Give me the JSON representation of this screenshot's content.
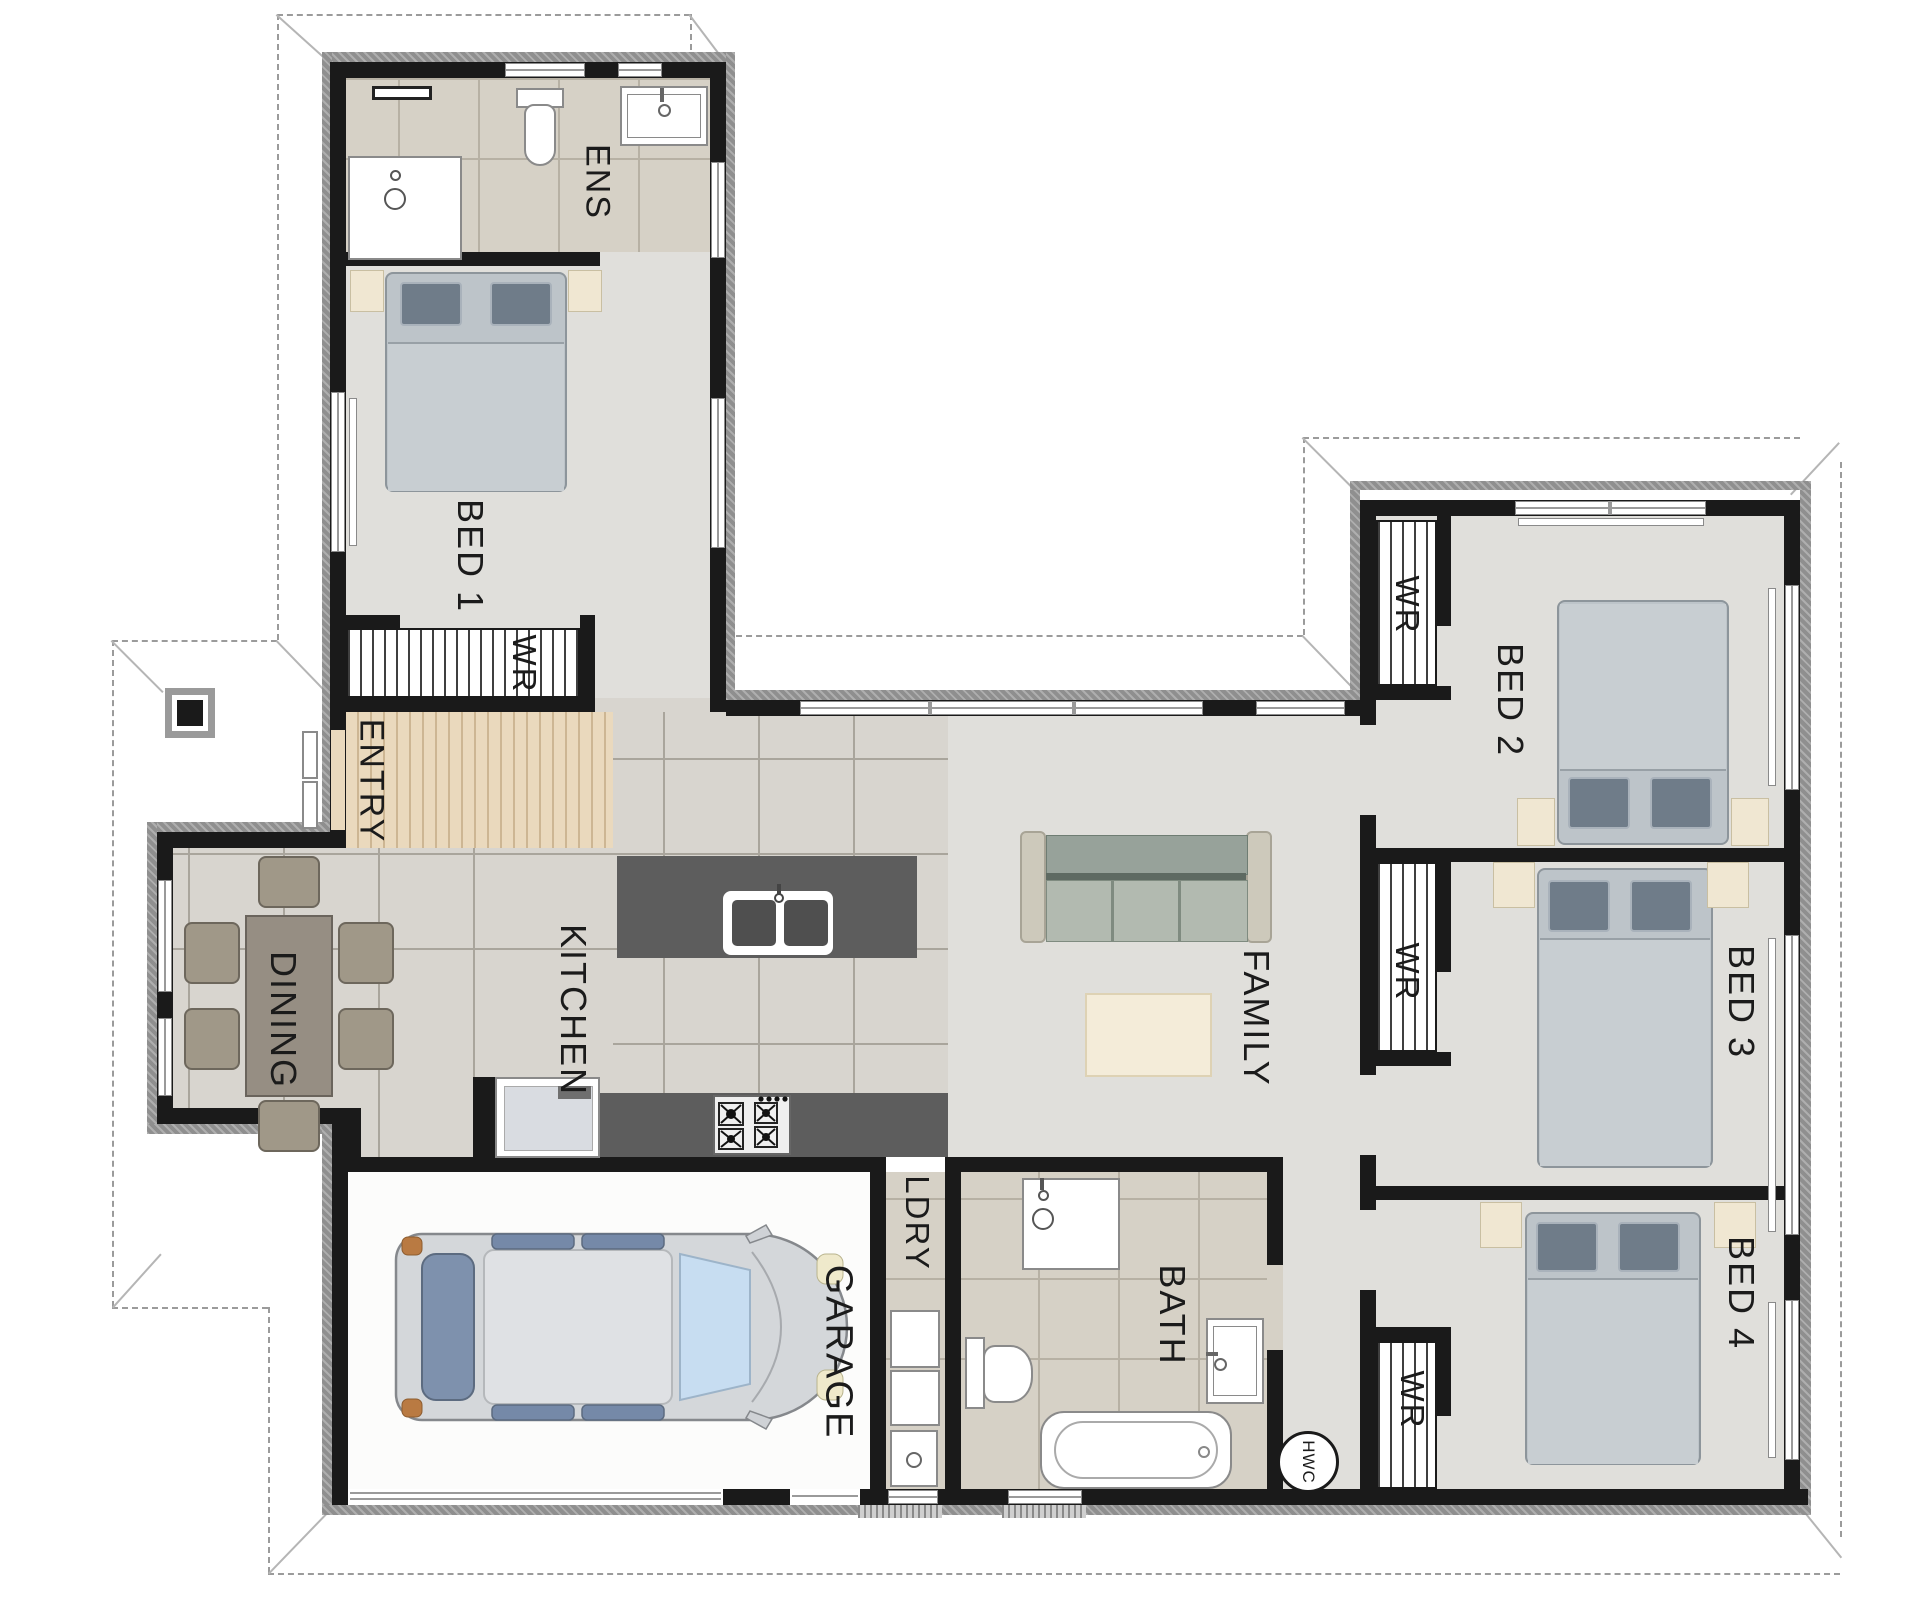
{
  "plan_type": "residential-floor-plan",
  "colors": {
    "wall": "#1a1a1a",
    "exterior_trim": "#8f8f8f",
    "carpet": "#e0dfdb",
    "tile": "#d8d5cf",
    "wet_tile": "#d6d1c6",
    "entry_wood": "#ead9bd",
    "bench_dark": "#5d5d5d",
    "cream_accent": "#f0e7d2",
    "roof_dash": "#9b9b9b",
    "bed_fill": "#bdc4c9",
    "sofa_fill": "#b2bab0"
  },
  "rooms": [
    {
      "id": "ens",
      "label": "ENS",
      "type": "ensuite"
    },
    {
      "id": "bed1",
      "label": "BED 1",
      "type": "bedroom"
    },
    {
      "id": "wr-bed1",
      "label": "WR",
      "type": "wardrobe"
    },
    {
      "id": "entry",
      "label": "ENTRY",
      "type": "entry"
    },
    {
      "id": "dining",
      "label": "DINING",
      "type": "dining"
    },
    {
      "id": "kitchen",
      "label": "KITCHEN",
      "type": "kitchen"
    },
    {
      "id": "family",
      "label": "FAMILY",
      "type": "living"
    },
    {
      "id": "bed2",
      "label": "BED 2",
      "type": "bedroom"
    },
    {
      "id": "wr-bed2",
      "label": "WR",
      "type": "wardrobe"
    },
    {
      "id": "bed3",
      "label": "BED 3",
      "type": "bedroom"
    },
    {
      "id": "wr-bed3",
      "label": "WR",
      "type": "wardrobe"
    },
    {
      "id": "bed4",
      "label": "BED 4",
      "type": "bedroom"
    },
    {
      "id": "wr-bed4",
      "label": "WR",
      "type": "wardrobe"
    },
    {
      "id": "ldry",
      "label": "LDRY",
      "type": "laundry"
    },
    {
      "id": "bath",
      "label": "BATH",
      "type": "bathroom"
    },
    {
      "id": "hwc",
      "label": "HWC",
      "type": "hot-water-cylinder"
    },
    {
      "id": "garage",
      "label": "GARAGE",
      "type": "garage"
    }
  ],
  "fixtures": [
    "shower",
    "toilet",
    "vanity",
    "double-bed x4",
    "bedside-tables",
    "dining-table-6-chairs",
    "kitchen-island-double-sink",
    "cooktop",
    "fridge",
    "sofa-3-seat",
    "rug",
    "bathtub",
    "laundry-tub",
    "car",
    "porch-post",
    "hot-water-cylinder"
  ]
}
